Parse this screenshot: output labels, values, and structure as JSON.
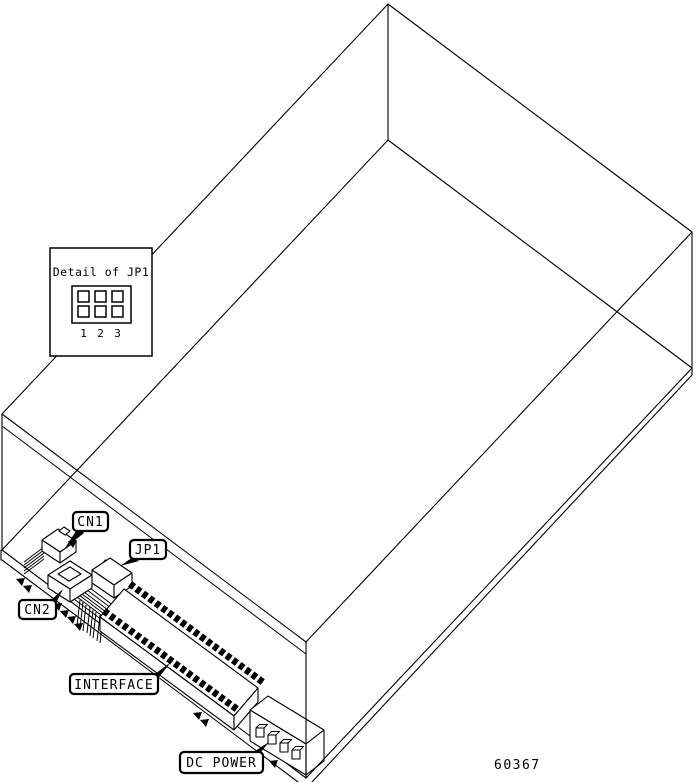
{
  "figure": {
    "type": "isometric-wireframe-diagram",
    "subject": "drive enclosure with rear circuit-board connectors",
    "part_number": "60367",
    "colors": {
      "line": "#000000",
      "background": "#ffffff"
    }
  },
  "detail_inset": {
    "title": "Detail of JP1",
    "jumper_grid": {
      "rows": 2,
      "cols": 3
    },
    "pin_numbers": [
      "1",
      "2",
      "3"
    ]
  },
  "callouts": {
    "cn1": {
      "label": "CN1"
    },
    "jp1": {
      "label": "JP1"
    },
    "cn2": {
      "label": "CN2"
    },
    "interface": {
      "label": "INTERFACE"
    },
    "dc_power": {
      "label": "DC POWER"
    }
  }
}
